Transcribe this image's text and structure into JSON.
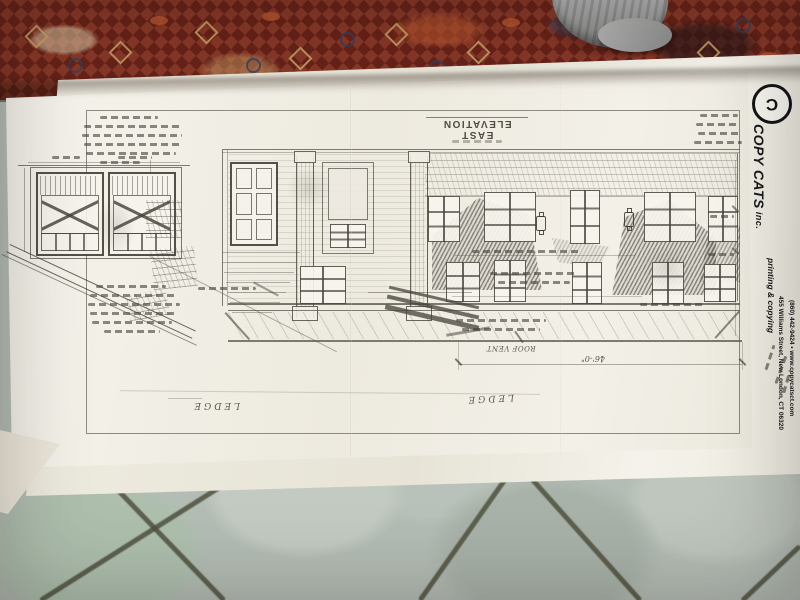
{
  "branding": {
    "logo_letter": "C",
    "name": "COPY CATS",
    "suffix": " inc.",
    "tagline": "printing & copying",
    "address": "455 Williams Street, New London, CT 06320",
    "phone_web": "(860) 442-9424 • www.copycatsct.com"
  },
  "drawing": {
    "title": "EAST ELEVATION",
    "label_roof_vent": "ROOF VENT",
    "label_ledge_left": "LEDGE",
    "label_ledge_right": "LEDGE",
    "dim_overall": "46'-0\""
  },
  "colors": {
    "paper": "#f3f0e8",
    "pencil": "#4c4840",
    "carpet_red": "#7c2a1d",
    "carpet_gold": "#c9a269",
    "carpet_navy": "#32405e",
    "tile_grey_green": "#b4bdb5",
    "grout": "#50513f",
    "sock_grey": "#9a9a9a",
    "logo_black": "#141414"
  }
}
